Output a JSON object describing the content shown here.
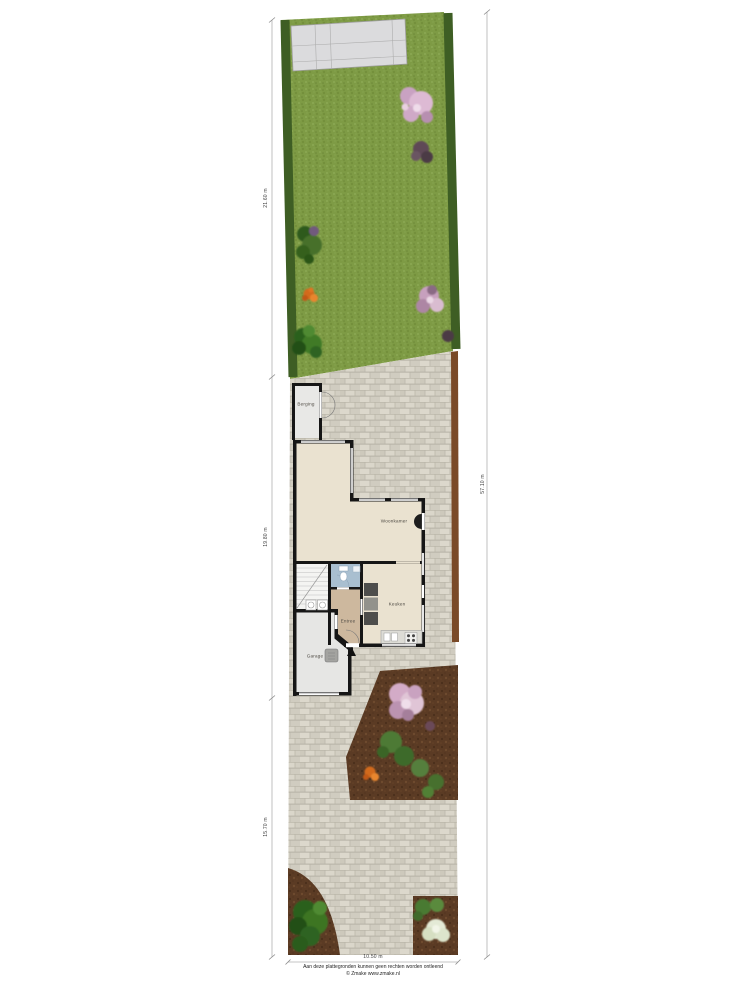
{
  "plan": {
    "rooms": {
      "berging": "Berging",
      "woonkamer": "Woonkamer",
      "keuken": "Keuken",
      "entree": "Entree",
      "garage": "Garage"
    },
    "dimensions": {
      "garden_depth": "21.60 m",
      "house_depth": "19.80 m",
      "frontyard_depth": "15.70 m",
      "total_depth": "57.10 m",
      "plot_width": "10.50 m"
    },
    "footer": {
      "disclaimer": "Aan deze plattegronden kunnen geen rechten worden ontleend",
      "credit": "© Zmake www.zmake.nl"
    },
    "icons": {
      "entrance_marker": "entrance-arrow-icon",
      "toilet": "toilet-icon",
      "stairs": "staircase-icon",
      "sink": "kitchen-sink-icon",
      "stove": "stove-icon",
      "washer": "appliance-icon"
    },
    "colors": {
      "grass": "#7d9a44",
      "hedge": "#3e5e24",
      "paving": "#d6d2c6",
      "soil": "#5b3b24",
      "room_floor": "#eae2d0",
      "hall_floor": "#cdb89e",
      "toilet_floor": "#a9bfd0",
      "garage_floor": "#e6e6e4",
      "wall": "#161616",
      "terrace_slabs": "#dbdbdd",
      "fence": "#7a4a28"
    }
  }
}
